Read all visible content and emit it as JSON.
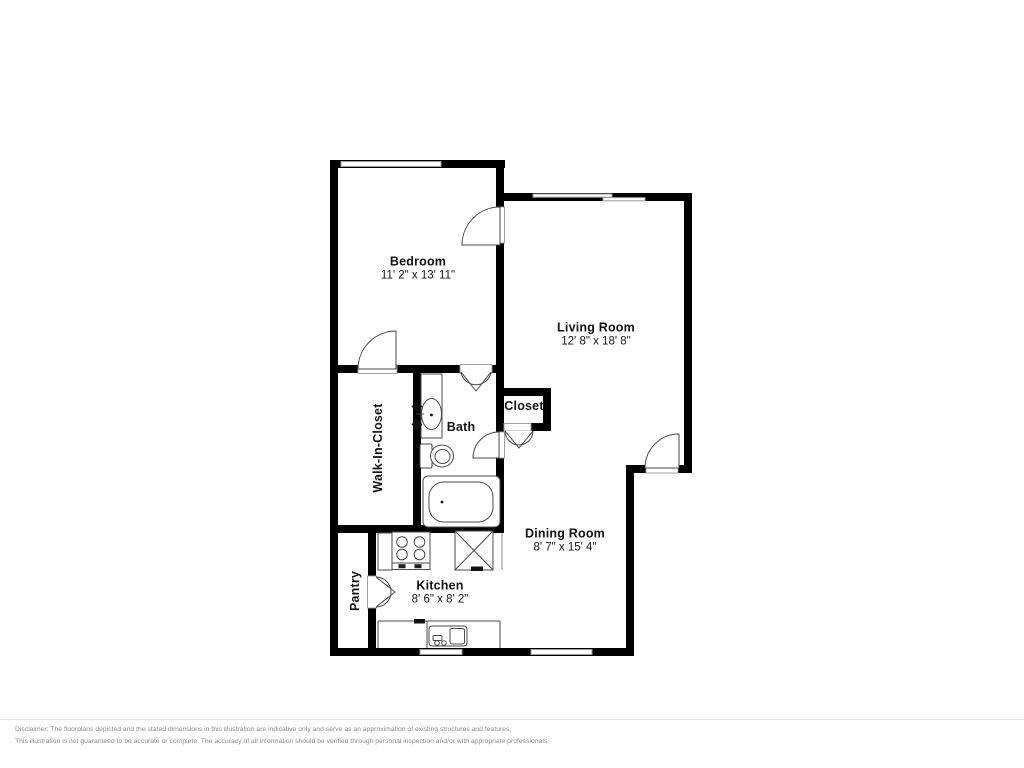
{
  "rooms": [
    {
      "name": "Bedroom",
      "dims": "11' 2\" x 13' 11\""
    },
    {
      "name": "Living Room",
      "dims": "12' 8\" x 18' 8\""
    },
    {
      "name": "Walk-In-Closet",
      "dims": ""
    },
    {
      "name": "Bath",
      "dims": ""
    },
    {
      "name": "Closet",
      "dims": ""
    },
    {
      "name": "Dining Room",
      "dims": "8' 7\" x 15' 4\""
    },
    {
      "name": "Kitchen",
      "dims": "8' 6\" x 8' 2\""
    },
    {
      "name": "Pantry",
      "dims": ""
    }
  ],
  "disclaimer": {
    "line1": "Disclaimer: The floorplans depicted and the stated dimensions in this illustration are indicative only and serve as an approximation of existing structures and features.",
    "line2": "This illustration is not guaranteed to be accurate or complete. The accuracy of all information should be verified through personal inspection and/or with appropriate professionals."
  },
  "colors": {
    "wall": "#000000",
    "background": "#ffffff",
    "fixture_line": "#4a4a4a",
    "window_line": "#9a9a9a",
    "label_text": "#141414",
    "disclaimer_text": "#8a8a8a"
  }
}
